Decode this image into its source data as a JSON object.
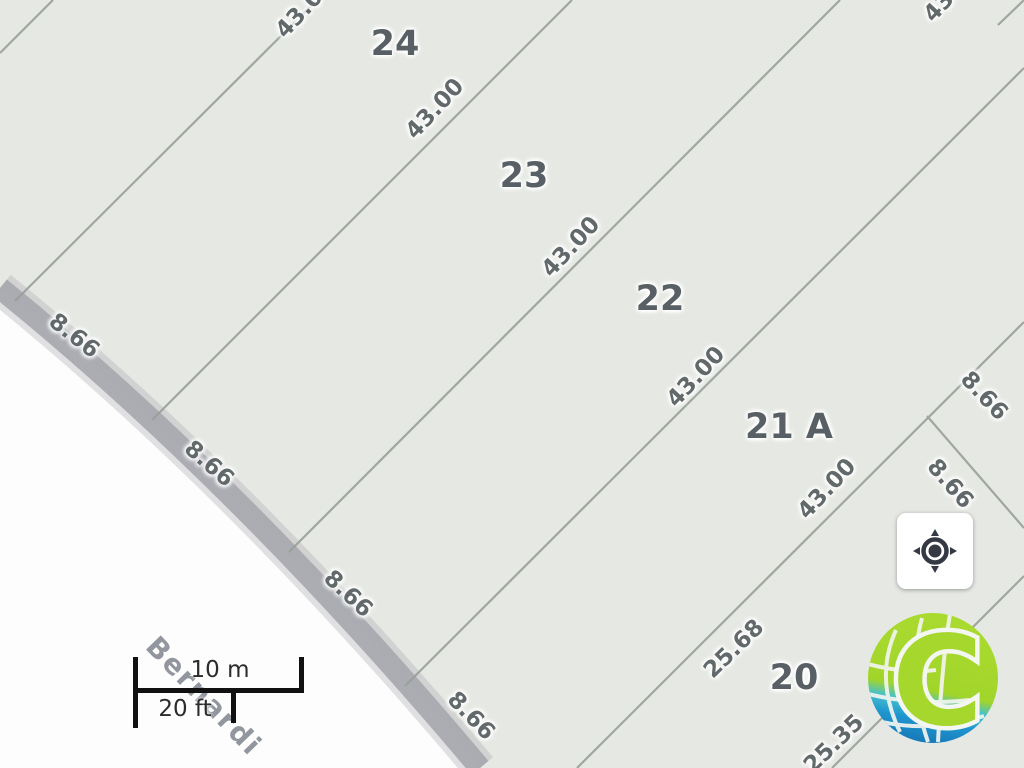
{
  "map": {
    "street_name": "Bernardi",
    "parcels": [
      {
        "id": "24"
      },
      {
        "id": "23"
      },
      {
        "id": "22"
      },
      {
        "id": "21 A"
      },
      {
        "id": "20"
      }
    ],
    "dimensions": {
      "lot_depths": [
        "43.00",
        "43.00",
        "43.00",
        "43.00",
        "43.00",
        "43.00"
      ],
      "lot_frontages_left": [
        "8.66",
        "8.66",
        "8.66",
        "8.66"
      ],
      "lot_frontages_right": [
        "8.66",
        "8.66"
      ],
      "corner_lot_sides": [
        "25.68",
        "25.35"
      ]
    }
  },
  "scale_bar": {
    "metric_label": "10 m",
    "imperial_label": "20 ft"
  },
  "controls": {
    "locate_button_icon": "my-location-crosshair"
  },
  "branding": {
    "logo_letter": "C"
  },
  "colors": {
    "parcel_fill": "#e6e9e3",
    "boundary_line": "#98a098",
    "road_fill": "#fdfdfd",
    "road_edge": "#a8aab0",
    "parcel_label_text": "#596065",
    "dimension_label_text": "#62696b",
    "street_label_text": "#8a8e96",
    "scale_bar": "#111111",
    "logo_green": "#a5d72c",
    "logo_blue": "#1b86c9"
  }
}
